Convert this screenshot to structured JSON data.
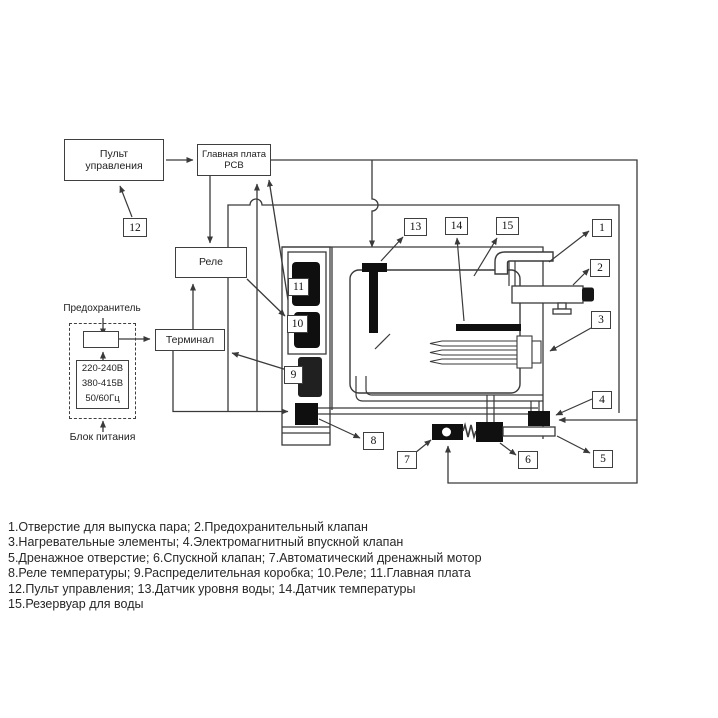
{
  "diagram": {
    "control_panel": {
      "line1": "Пульт",
      "line2": "управления"
    },
    "main_board": {
      "line1": "Главная плата",
      "line2": "PCB"
    },
    "relay": "Реле",
    "terminal": "Терминал",
    "fuse_title": "Предохранитель",
    "power_supply": "Блок питания",
    "voltage": {
      "line1": "220-240В",
      "line2": "380-415В",
      "line3": "50/60Гц"
    },
    "part_numbers": [
      "1",
      "2",
      "3",
      "4",
      "5",
      "6",
      "7",
      "8",
      "9",
      "10",
      "11",
      "12",
      "13",
      "14",
      "15"
    ]
  },
  "legend": {
    "lines": [
      "1.Отверстие для выпуска пара; 2.Предохранительный клапан",
      "3.Нагревательные элементы; 4.Электромагнитный впускной клапан",
      "5.Дренажное отверстие; 6.Спускной клапан; 7.Автоматический дренажный мотор",
      "8.Реле температуры; 9.Распределительная коробка; 10.Реле; 11.Главная плата",
      "12.Пульт управления; 13.Датчик уровня воды; 14.Датчик температуры",
      "15.Резервуар для воды"
    ]
  },
  "colors": {
    "line": "#3a3a3a",
    "component_fill": "#0f0f0f",
    "background": "#ffffff"
  }
}
